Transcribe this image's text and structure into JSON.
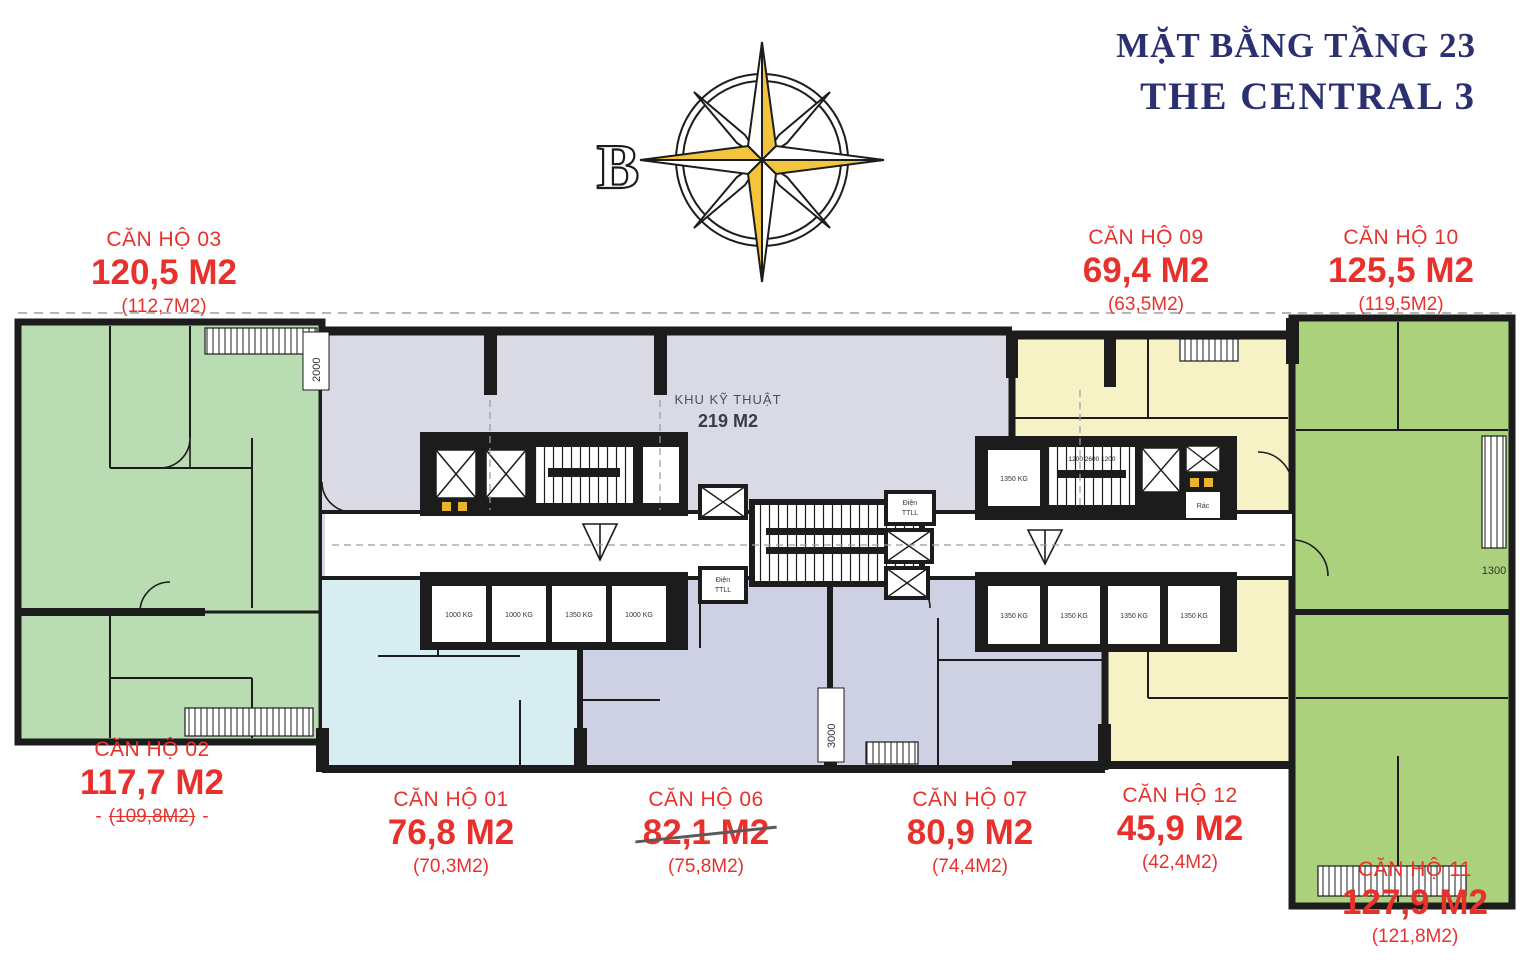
{
  "title": {
    "line1": "MẶT BẰNG TẦNG 23",
    "line2": "THE CENTRAL 3"
  },
  "compass": {
    "north_label": "B"
  },
  "apartments": [
    {
      "id": "03",
      "name": "CĂN HỘ 03",
      "area": "120,5 M2",
      "area_old": "(112,7M2)"
    },
    {
      "id": "02",
      "name": "CĂN HỘ 02",
      "area": "117,7 M2",
      "area_old": "(109,8M2)",
      "dash_left": "-",
      "dash_right": "-"
    },
    {
      "id": "01",
      "name": "CĂN HỘ 01",
      "area": "76,8 M2",
      "area_old": "(70,3M2)"
    },
    {
      "id": "06",
      "name": "CĂN HỘ 06",
      "area": "82,1 M2",
      "area_old": "(75,8M2)"
    },
    {
      "id": "07",
      "name": "CĂN HỘ 07",
      "area": "80,9 M2",
      "area_old": "(74,4M2)"
    },
    {
      "id": "12",
      "name": "CĂN HỘ 12",
      "area": "45,9 M2",
      "area_old": "(42,4M2)"
    },
    {
      "id": "09",
      "name": "CĂN HỘ 09",
      "area": "69,4 M2",
      "area_old": "(63,5M2)"
    },
    {
      "id": "10",
      "name": "CĂN HỘ 10",
      "area": "125,5 M2",
      "area_old": "(119,5M2)"
    },
    {
      "id": "11",
      "name": "CĂN HỘ 11",
      "area": "127,9 M2",
      "area_old": "(121,8M2)"
    }
  ],
  "plan": {
    "technical_room": {
      "line1": "KHU KỸ THUẬT",
      "line2": "219 M2"
    },
    "lifts_left": [
      "1000 KG",
      "1000 KG",
      "1350 KG",
      "1000 KG"
    ],
    "lifts_right": [
      "1350 KG",
      "1350 KG",
      "1350 KG",
      "1350 KG"
    ],
    "lift_right_single": "1350 KG",
    "trash": "Rác",
    "elec1": {
      "l1": "Điện",
      "l2": "TTLL"
    },
    "elec2": {
      "l1": "Điện",
      "l2": "TTLL"
    },
    "dims": {
      "top": "2000",
      "mid": "3000",
      "right": "1300",
      "stair": "1200  2600  1200"
    }
  },
  "colors": {
    "red": "#e8312c",
    "navy": "#2b3170",
    "wall": "#1c1c1c",
    "green_left": "#b9dcb3",
    "green_right": "#abd17c",
    "cyan": "#d8edf1",
    "lavender": "#ced1e4",
    "gray": "#d9dae4",
    "yellow": "#f6f2c6",
    "gold": "#f2c53d"
  }
}
